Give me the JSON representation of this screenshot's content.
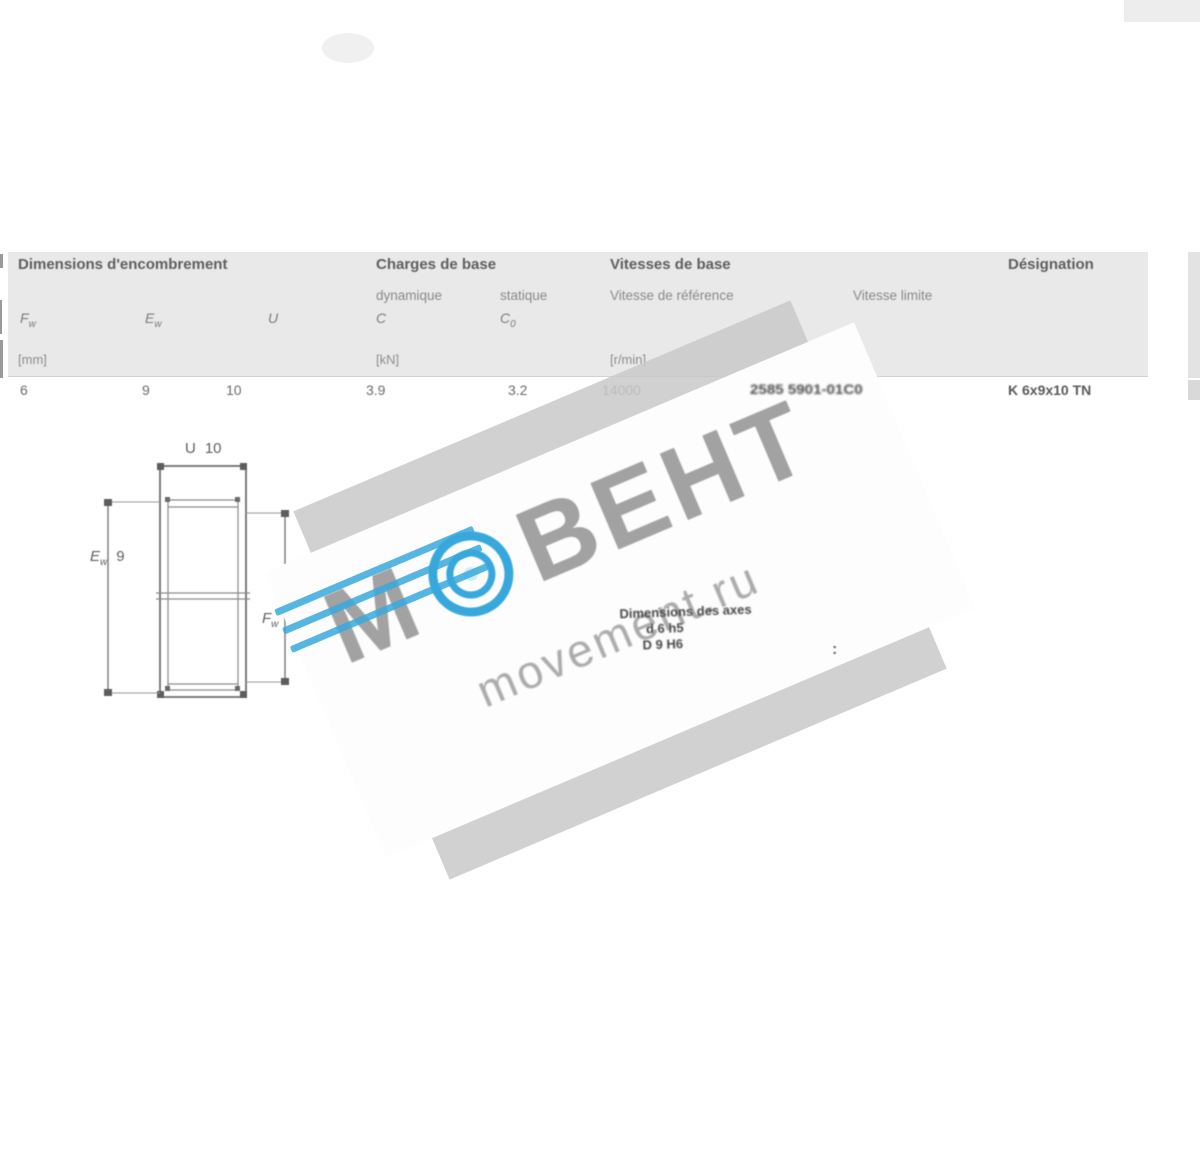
{
  "table": {
    "groups": {
      "dimensions": {
        "title": "Dimensions d'encombrement"
      },
      "charges": {
        "title": "Charges de base",
        "sub1": "dynamique",
        "sub2": "statique"
      },
      "vitesses": {
        "title": "Vitesses de base",
        "sub1": "Vitesse de référence",
        "sub2": "Vitesse limite"
      },
      "designation": {
        "title": "Désignation"
      }
    },
    "symbols": {
      "fw": {
        "m": "F",
        "s": "w"
      },
      "ew": {
        "m": "E",
        "s": "w"
      },
      "u": {
        "m": "U"
      },
      "c": {
        "m": "C"
      },
      "c0": {
        "m": "C",
        "s": "0"
      }
    },
    "units": {
      "mm": "[mm]",
      "kn": "[kN]",
      "rmin": "[r/min]"
    },
    "row": {
      "fw": "6",
      "ew": "9",
      "u": "10",
      "c": "3.9",
      "c0": "3.2",
      "ref_speed": "14000",
      "limit_speed_obscured": "2585 5901-01C0",
      "designation": "K 6x9x10 TN"
    }
  },
  "drawing": {
    "dim_top": {
      "m": "U",
      "val": "10"
    },
    "dim_left": {
      "m": "E",
      "s": "w",
      "val": "9"
    },
    "dim_right": {
      "m": "F",
      "s": "w",
      "val": "6"
    }
  },
  "watermark": {
    "letter_m": "М",
    "letters": "ВЕНТ",
    "domain": "movement.ru",
    "note_line1": "Dimensions des axes",
    "note_line2": "d 6 h5",
    "note_line3": "D 9 H6",
    "colon": ":",
    "blue": "#38a8dc"
  }
}
